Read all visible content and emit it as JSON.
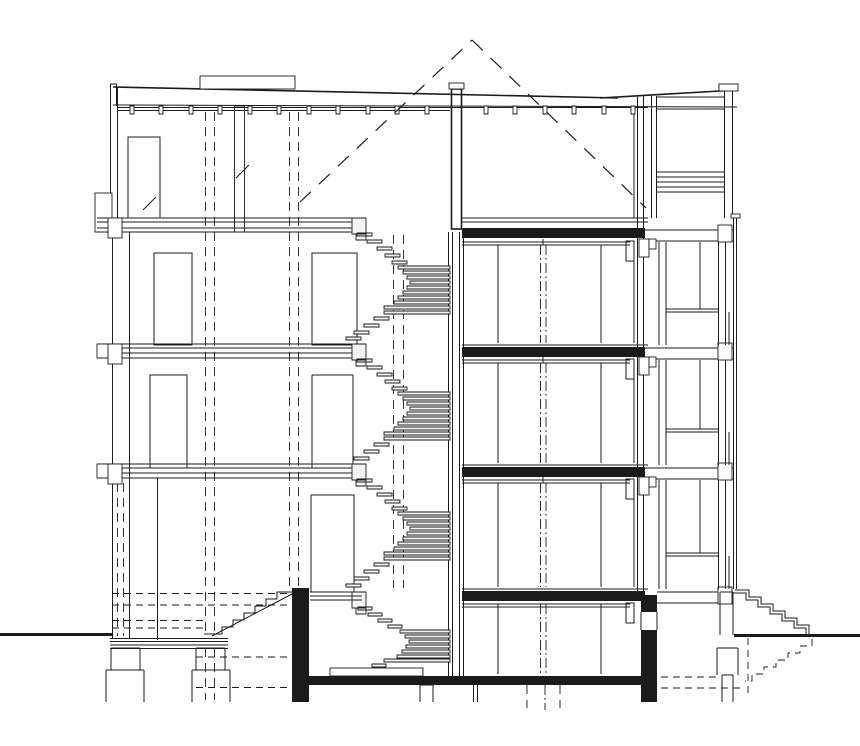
{
  "title": "Building cross-section drawing",
  "colors": {
    "ink": "#1b1b1b",
    "bg": "#ffffff",
    "tread_fill": "#f4f4f4"
  },
  "drawing": {
    "type": "architectural-section",
    "levels_above_entry": 5,
    "stair_flights_visible": 4,
    "loggia_levels_right": 3,
    "roof_terrace": true,
    "sunken_hall": true
  },
  "components": {
    "roof": "Flat roof with rooflight curb and dashed opening apex",
    "rooflight_curb": "Rooflight curb on roof",
    "apex_dashes": "Dashed projection of roof opening",
    "joists": "Roof joist row",
    "left_wall": "Left external wall with windows",
    "center_wall": "Spine wall beside spiral stair",
    "spiral_stair": "Central spiral stair in section",
    "entry_stair": "External entry steps at left",
    "exterior_stair_right": "Garden steps at right",
    "basement_stair_dashed": "Hidden basement steps (dashed)",
    "right_facade": "Glazed facade with mullions",
    "loggias": "Stacked loggias with balustrades",
    "roof_terrace": "Roof terrace with louvered rail",
    "screen": "Outer screen line at right",
    "slabs": "Floor slabs (cut, filled black at right)",
    "piers": "Foundation piers below grade",
    "grade": "Ground line",
    "hall_floor": "Sunken hall floor slab",
    "doors": "Interior door elevations",
    "window": "Top floor window"
  }
}
